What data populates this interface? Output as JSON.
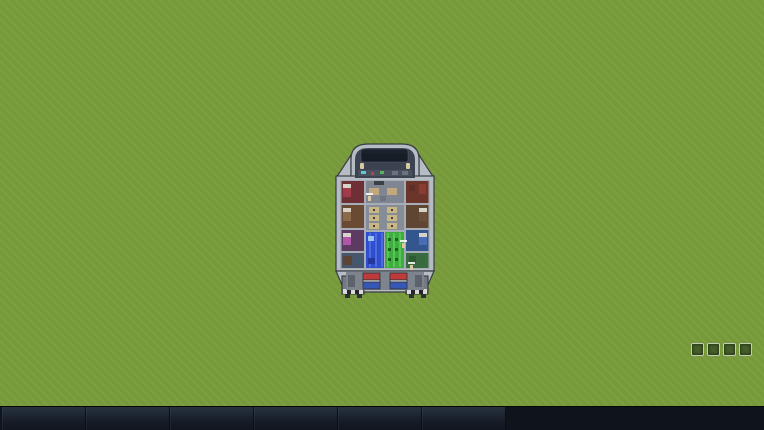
{
  "toolbar": {
    "items": [
      "Hull",
      "Power",
      "Pipes",
      "Floor Plan",
      "Build Object",
      "Tasks"
    ]
  },
  "status": {
    "temperature": "10 C",
    "air": "CO2 0% / O2 100%",
    "planet": "Planet1",
    "terrain": "Grass",
    "hotkeys": [
      "G",
      "H",
      "J",
      "L"
    ]
  },
  "ship": {
    "warning_line1": "No Water",
    "warning_line2": "Problem",
    "pilot_left": "Chris",
    "pilot_right": "Chris"
  },
  "credit": "Starship Colony - Black Belt Software - Early Screenshot",
  "colors": {
    "grass": "#76993a",
    "grass_light": "#9db84e",
    "grass_dark": "#55762a",
    "bush": "#35571f",
    "bush_dark": "#274115",
    "gravel": "#b3a27e",
    "rock_edge": "#8b8376",
    "rock_mid": "#6b6358",
    "rock_core": "#4a4239",
    "rock_rim": "#302e28",
    "hull": "#b6bcc4",
    "water_blue": "#2e4fd0",
    "hydro_green": "#3dae3d",
    "toolbar_bg": "#0f141c"
  }
}
